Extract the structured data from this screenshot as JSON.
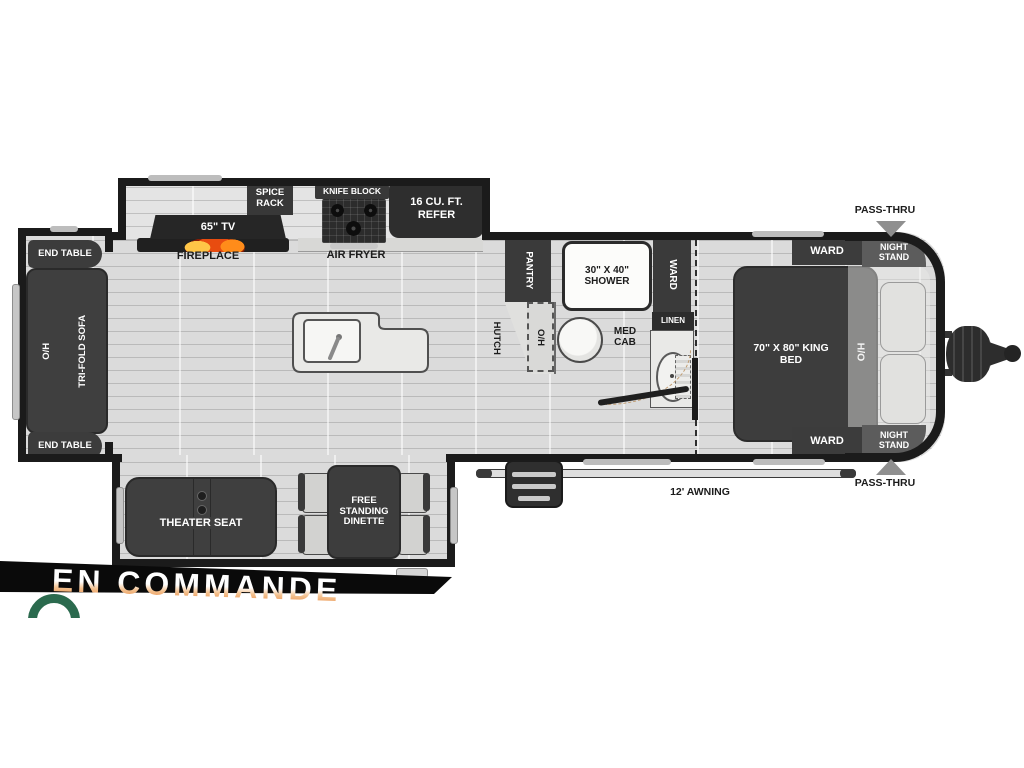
{
  "banner": {
    "status_label": "EN COMMANDE"
  },
  "colors": {
    "wall": "#1b1b1b",
    "furniture_dark": "#3c3c3c",
    "floor": "#dbdbdb",
    "banner_bg": "#0a0a0a",
    "banner_text_top": "#ffffff",
    "banner_text_bottom": "#e8833a",
    "flame_orange": "#ff7a1a",
    "logo_ring_green": "#2b6a4e"
  },
  "floorplan": {
    "rear_slide": {
      "end_tables": [
        "END TABLE",
        "END TABLE"
      ],
      "sofa_overhead": "O/H",
      "sofa": "TRI-FOLD SOFA"
    },
    "entertainment": {
      "tv": "65\" TV",
      "fireplace": "FIREPLACE",
      "spice_rack": "SPICE RACK"
    },
    "kitchen": {
      "knife_block": "KNIFE BLOCK",
      "air_fryer": "AIR FRYER",
      "refrigerator": "16 CU. FT. REFER",
      "pantry": "PANTRY",
      "hutch": "HUTCH",
      "hutch_overhead": "O/H"
    },
    "bathroom": {
      "shower": "30\" X 40\" SHOWER",
      "wardrobe": "WARD",
      "linen": "LINEN",
      "med_cab": "MED CAB"
    },
    "bedroom": {
      "bed": "70\" X 80\" KING BED",
      "overhead": "H/O",
      "wardrobes": [
        "WARD",
        "WARD"
      ],
      "night_stands": [
        "NIGHT STAND",
        "NIGHT STAND"
      ],
      "pass_thru": [
        "PASS-THRU",
        "PASS-THRU"
      ]
    },
    "living": {
      "theater_seat": "THEATER SEAT",
      "dinette": "FREE STANDING DINETTE"
    },
    "exterior": {
      "awning": "12' AWNING",
      "awning_partial": "AWNING"
    }
  }
}
